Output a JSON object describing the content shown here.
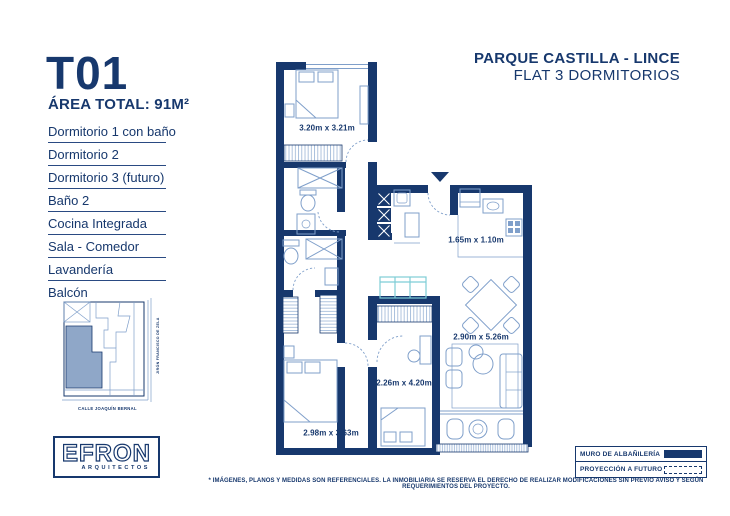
{
  "colors": {
    "navy": "#17386d",
    "furniture": "#7f9fca",
    "hatch": "#9ab4d6",
    "cyan": "#7ecdd6",
    "map_fill": "#8fa7c8",
    "sep": "#2a4a82"
  },
  "header": {
    "project": "PARQUE CASTILLA - LINCE",
    "subtitle": "FLAT 3 DORMITORIOS"
  },
  "unit": {
    "code": "T01",
    "area_label": "ÁREA TOTAL: 91M²"
  },
  "rooms": [
    "Dormitorio 1 con baño",
    "Dormitorio 2",
    "Dormitorio 3 (futuro)",
    "Baño 2",
    "Cocina Integrada",
    "Sala - Comedor",
    "Lavandería",
    "Balcón"
  ],
  "plan": {
    "dim_dorm1": "3.20m x 3.21m",
    "dim_kitchen": "1.65m x 1.10m",
    "dim_sala": "2.90m x 5.26m",
    "dim_dorm3": "2.26m x 4.20m",
    "dim_dorm2": "2.98m x 3.63m"
  },
  "map": {
    "street_right": "JIRÓN FRANCISCO DE ZELA",
    "street_bottom": "CALLE JOAQUÍN BERNAL"
  },
  "logo": {
    "name": "EFRON",
    "tagline": "ARQUITECTOS"
  },
  "legend": {
    "items": [
      {
        "label": "MURO DE ALBAÑILERÍA",
        "swatch": "solid"
      },
      {
        "label": "PROYECCIÓN A FUTURO",
        "swatch": "dashed"
      }
    ]
  },
  "disclaimer": "* IMÁGENES, PLANOS Y MEDIDAS SON REFERENCIALES. LA INMOBILIARIA SE RESERVA EL DERECHO DE REALIZAR MODIFICACIONES SIN PREVIO AVISO Y SEGÚN REQUERIMIENTOS DEL PROYECTO."
}
